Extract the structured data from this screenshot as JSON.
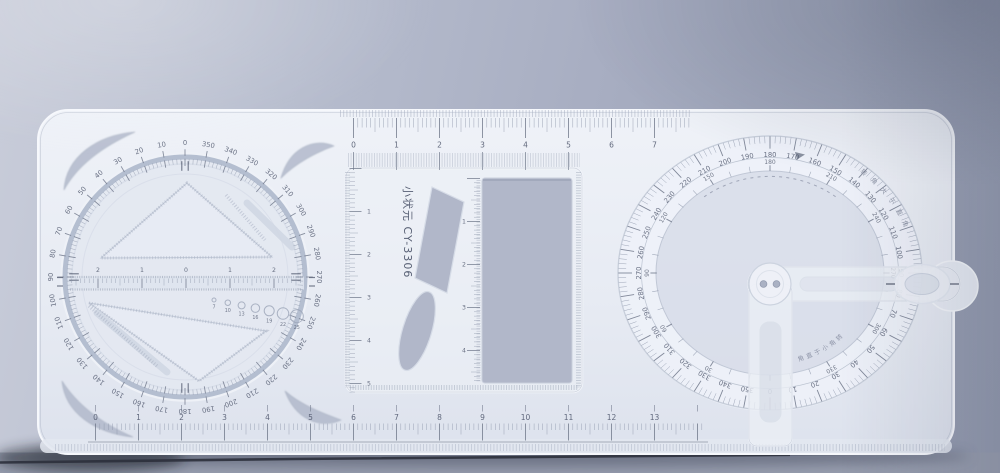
{
  "scene": {
    "description": "Photo of a translucent plastic multifunctional drafting ruler with a rotating stencil disc, template cutouts and a protractor with swing arm, lying on a blue-grey surface",
    "brand_text": "小状元 CY-3306"
  },
  "colors": {
    "background": "#a8aec2",
    "body_plastic": "#e9edf4",
    "cutout": "#b1b7c9",
    "markings": "#4a5268",
    "surface_shadow_line": "#2c303c"
  },
  "left_dial": {
    "degree_labels": [
      0,
      10,
      20,
      30,
      40,
      50,
      60,
      70,
      80,
      90,
      100,
      110,
      120,
      130,
      140,
      150,
      160,
      170,
      180,
      190,
      200,
      210,
      220,
      230,
      240,
      250,
      260,
      270,
      280,
      290,
      300,
      310,
      320,
      330,
      340,
      350
    ],
    "center_ruler_labels": [
      "2",
      "1",
      "0",
      "1",
      "2"
    ],
    "circle_template_labels": [
      "7",
      "10",
      "13",
      "16",
      "19",
      "22",
      "25"
    ]
  },
  "rulers": {
    "top_numbers": [
      "0",
      "1",
      "2",
      "3",
      "4",
      "5",
      "6",
      "7"
    ],
    "bottom_numbers": [
      "0",
      "1",
      "2",
      "3",
      "4",
      "5",
      "6",
      "7",
      "8",
      "9",
      "10",
      "11",
      "12",
      "13"
    ],
    "frame_left_numbers": [
      "1",
      "2",
      "3",
      "4",
      "5"
    ],
    "frame_inner_numbers": [
      "1",
      "2",
      "3",
      "4"
    ]
  },
  "protractor": {
    "outer_degree_labels": [
      0,
      10,
      20,
      30,
      40,
      50,
      60,
      70,
      80,
      90,
      100,
      110,
      120,
      130,
      140,
      150,
      160,
      170,
      180,
      190,
      200,
      210,
      220,
      230,
      240,
      250,
      260,
      270,
      280,
      290,
      300,
      310,
      320,
      330,
      340,
      350
    ],
    "inner_degree_labels": [
      30,
      60,
      90,
      120,
      150,
      180,
      210,
      240,
      270,
      300,
      330
    ],
    "upper_arc_text": "转角大于直角",
    "lower_arc_text": "转角小于直角"
  }
}
